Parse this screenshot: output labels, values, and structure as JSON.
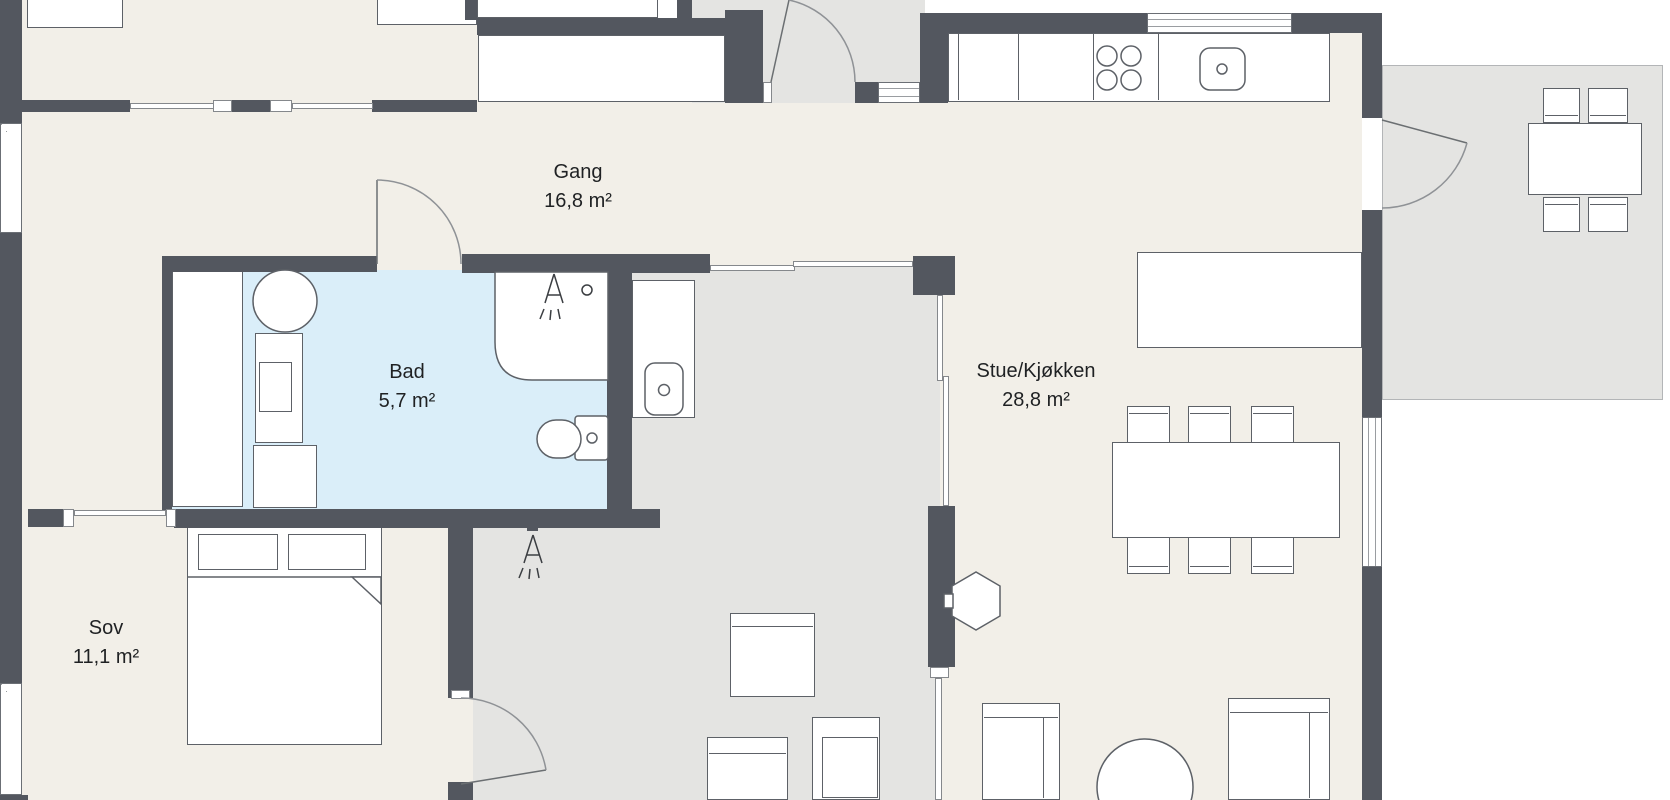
{
  "rooms": [
    {
      "id": "gang",
      "name": "Gang",
      "area": "16,8 m²"
    },
    {
      "id": "bad",
      "name": "Bad",
      "area": "5,7 m²"
    },
    {
      "id": "stue-kjokken",
      "name": "Stue/Kjøkken",
      "area": "28,8 m²"
    },
    {
      "id": "sov",
      "name": "Sov",
      "area": "11,1 m²"
    }
  ],
  "colors": {
    "wall": "#53575f",
    "floor_main": "#f2efe8",
    "floor_bathroom": "#daeef9",
    "floor_secondary": "#e4e4e2",
    "terrace_border": "#b3b5b7",
    "furniture_outline": "#5d6167",
    "door_arc": "#8f9296",
    "text": "#1f2123"
  },
  "icons": {
    "shower-head-icon": "triangle with spray dashes",
    "stove-burner-icon": "circle",
    "sink-drain-icon": "small circle",
    "toilet-icon": "bowl and cistern outline"
  }
}
